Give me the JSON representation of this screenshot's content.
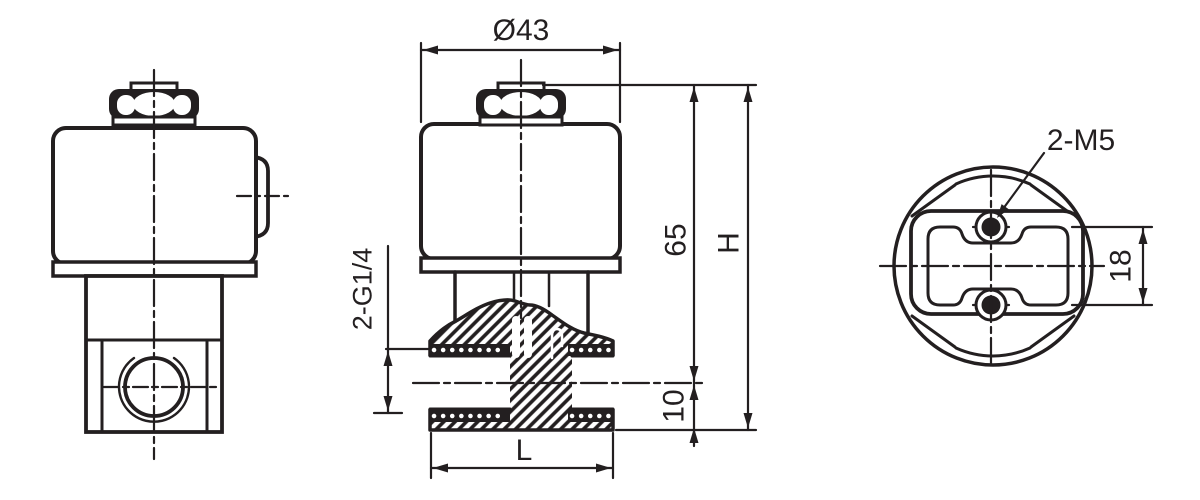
{
  "drawing": {
    "kind": "technical-drawing",
    "colors": {
      "line": "#231f20",
      "background": "#ffffff"
    },
    "labels": {
      "coil_diameter": "Ø43",
      "coil_height": "65",
      "overall_height": "H",
      "port_thread": "2-G1/4",
      "port_center_height": "10",
      "body_length": "L",
      "mounting_thread": "2-M5",
      "mounting_pitch": "18"
    }
  }
}
